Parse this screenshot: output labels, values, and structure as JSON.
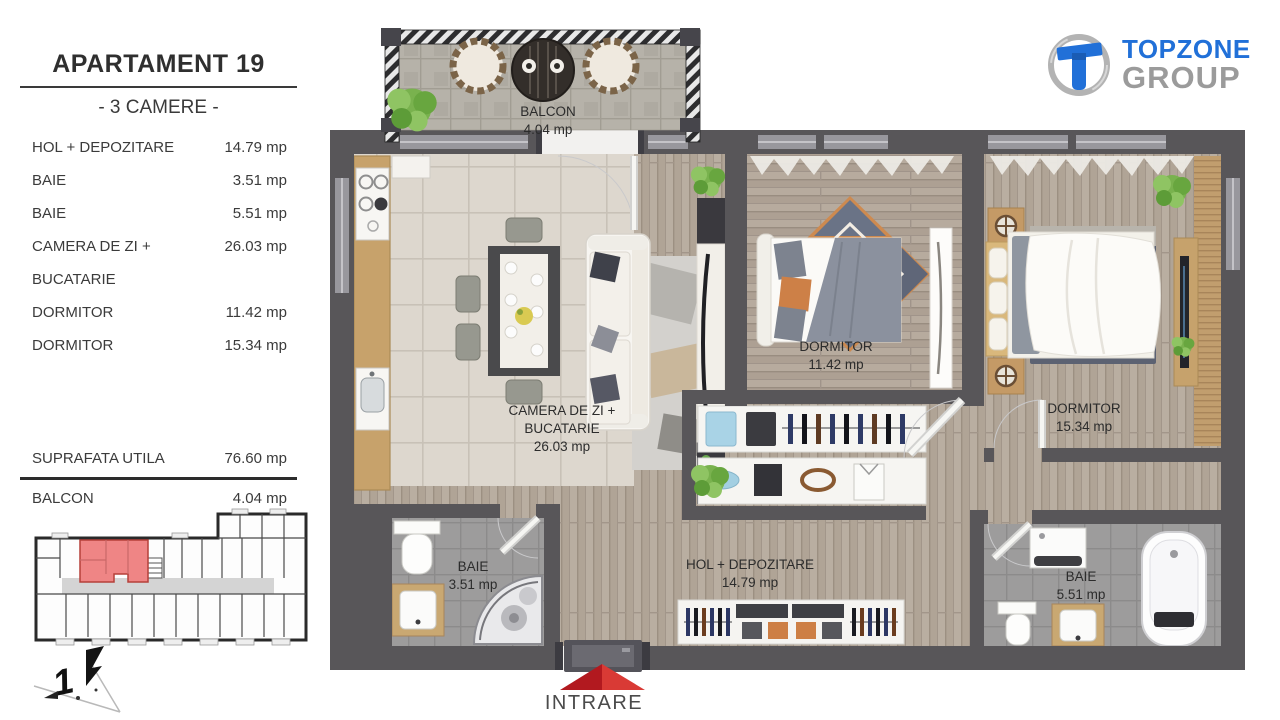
{
  "panel": {
    "title": "APARTAMENT 19",
    "subtitle": "- 3 CAMERE -",
    "rooms": [
      {
        "label": "HOL + DEPOZITARE",
        "area": "14.79 mp"
      },
      {
        "label": "BAIE",
        "area": "3.51 mp"
      },
      {
        "label": "BAIE",
        "area": "5.51 mp"
      },
      {
        "label": "CAMERA DE ZI +",
        "area": "26.03 mp"
      },
      {
        "label": "BUCATARIE",
        "area": ""
      },
      {
        "label": "DORMITOR",
        "area": "11.42 mp"
      },
      {
        "label": "DORMITOR",
        "area": "15.34 mp"
      }
    ],
    "total_label": "SUPRAFATA UTILA",
    "total_area": "76.60 mp",
    "balcony_label": "BALCON",
    "balcony_area": "4.04 mp"
  },
  "logo": {
    "line1": "TOPZONE",
    "line2": "GROUP",
    "blue": "#2170d8",
    "gray": "#9b9b9b"
  },
  "plan": {
    "balcony": {
      "name": "BALCON",
      "area": "4.04 mp"
    },
    "living": {
      "line1": "CAMERA DE ZI +",
      "line2": "BUCATARIE",
      "area": "26.03 mp"
    },
    "bedroom1": {
      "name": "DORMITOR",
      "area": "11.42 mp"
    },
    "bedroom2": {
      "name": "DORMITOR",
      "area": "15.34 mp"
    },
    "bath1": {
      "name": "BAIE",
      "area": "3.51 mp"
    },
    "bath2": {
      "name": "BAIE",
      "area": "5.51 mp"
    },
    "hall": {
      "name": "HOL + DEPOZITARE",
      "area": "14.79 mp"
    },
    "entrance": "INTRARE"
  },
  "colors": {
    "wall": "#585659",
    "entrance_arrow": "#c9252c",
    "minimap_highlight": "#ef8787"
  }
}
